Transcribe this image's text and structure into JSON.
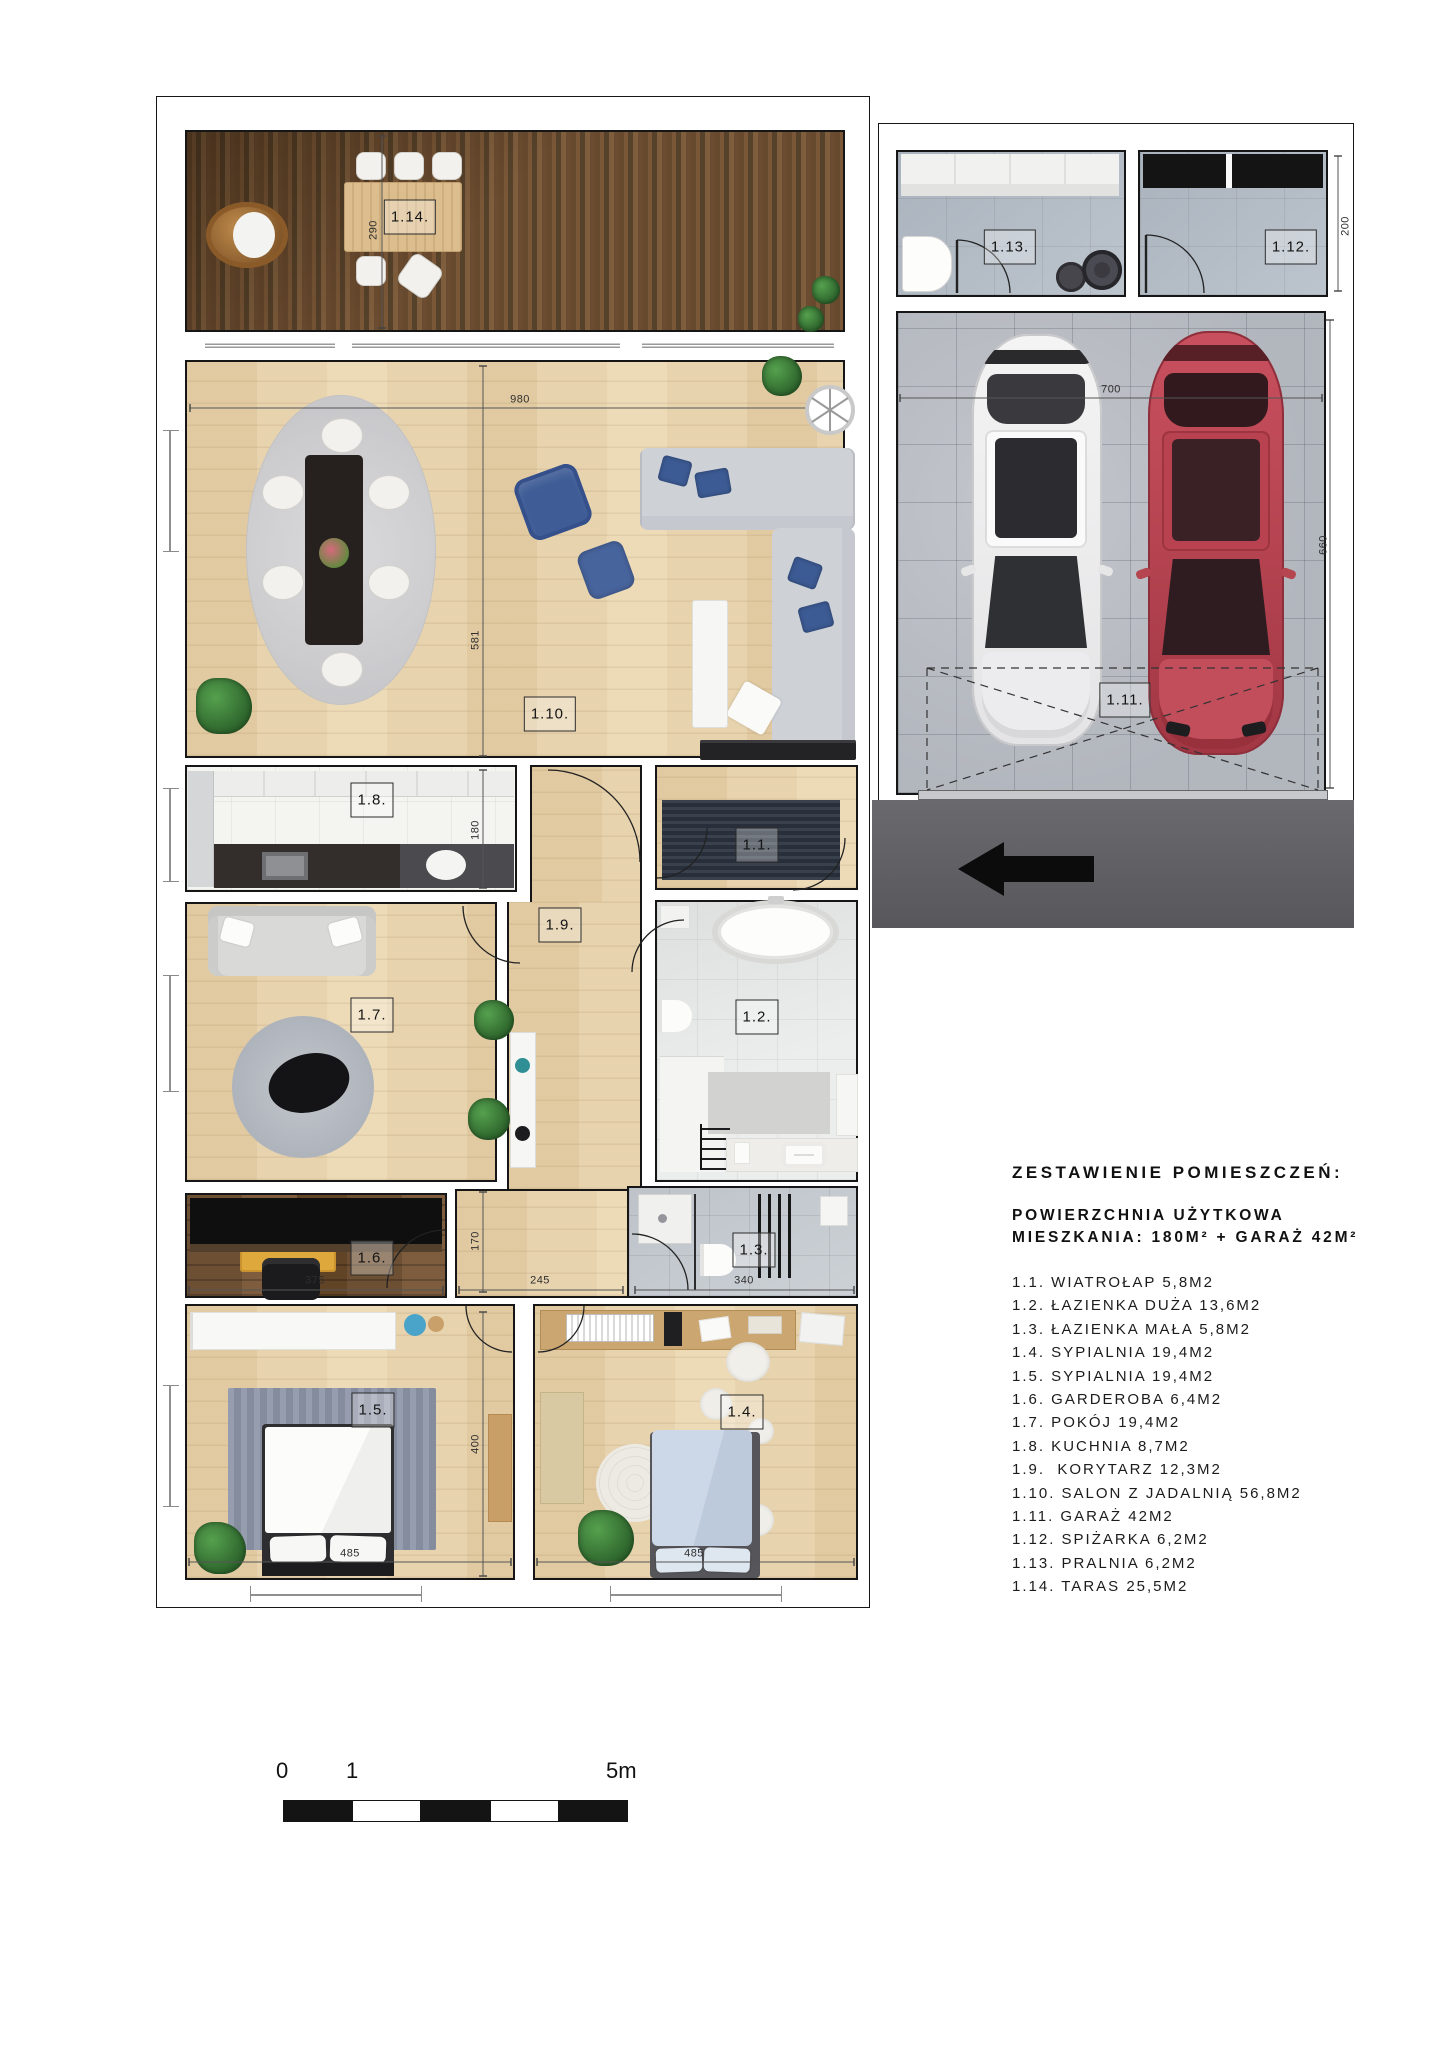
{
  "plan": {
    "rooms": {
      "label_1_1": "1.1.",
      "label_1_2": "1.2.",
      "label_1_3": "1.3.",
      "label_1_4": "1.4.",
      "label_1_5": "1.5.",
      "label_1_6": "1.6.",
      "label_1_7": "1.7.",
      "label_1_8": "1.8.",
      "label_1_9": "1.9.",
      "label_1_10": "1.10.",
      "label_1_11": "1.11.",
      "label_1_12": "1.12.",
      "label_1_13": "1.13.",
      "label_1_14": "1.14."
    },
    "dimensions": {
      "terrace_depth": "290",
      "living_width": "980",
      "living_height": "581",
      "kitchen_depth": "180",
      "garderoba_height": "170",
      "garderoba_width": "375",
      "corridor_width": "245",
      "bath_small_width": "340",
      "bedroom_height": "400",
      "bedroom5_width": "485",
      "bedroom4_width": "485",
      "garage_width": "700",
      "garage_height": "660",
      "pantry_height": "200"
    }
  },
  "legend": {
    "title": "ZESTAWIENIE POMIESZCZEŃ:",
    "subtitle_line1": "POWIERZCHNIA UŻYTKOWA",
    "subtitle_line2": "MIESZKANIA: 180M² + GARAŻ 42M²",
    "items": [
      "1.1. WIATROŁAP 5,8M2",
      "1.2. ŁAZIENKA DUŻA 13,6M2",
      "1.3. ŁAZIENKA MAŁA 5,8M2",
      "1.4. SYPIALNIA 19,4M2",
      "1.5. SYPIALNIA 19,4M2",
      "1.6. GARDEROBA 6,4M2",
      "1.7. POKÓJ 19,4M2",
      "1.8. KUCHNIA 8,7M2",
      "1.9.  KORYTARZ 12,3M2",
      "1.10. SALON Z JADALNIĄ 56,8M2",
      "1.11. GARAŻ 42M2",
      "1.12. SPIŻARKA 6,2M2",
      "1.13. PRALNIA 6,2M2",
      "1.14. TARAS 25,5M2"
    ]
  },
  "scale_bar": {
    "tick_zero": "0",
    "tick_one": "1",
    "tick_five": "5m"
  },
  "colors": {
    "white_car": "#f0f0f0",
    "red_car": "#b5454f",
    "sofa_gray": "#ced2d7",
    "pillow_blue": "#3c5a93",
    "navy_rug": "#2d3542",
    "driveway": "#646468"
  }
}
